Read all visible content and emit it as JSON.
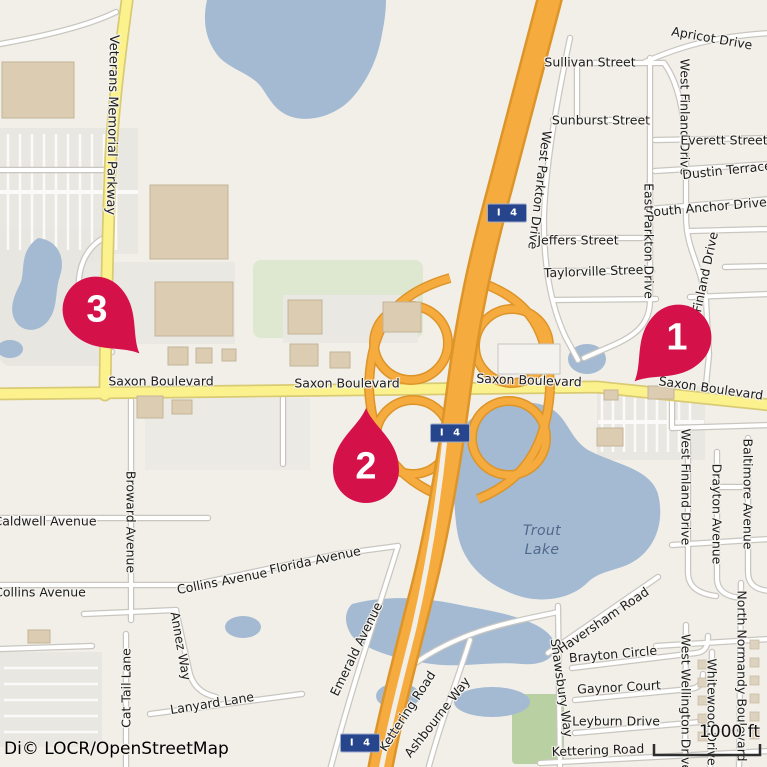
{
  "attribution": {
    "text": "Di© LOCR/OpenStreetMap"
  },
  "scale_bar": {
    "label": "1000 ft"
  },
  "shield_label": "I 4",
  "markers": [
    {
      "label": "1"
    },
    {
      "label": "2"
    },
    {
      "label": "3"
    }
  ],
  "water_label": {
    "line1": "Trout",
    "line2": "Lake"
  },
  "colors": {
    "marker": "#d5114a",
    "highway_fill": "#f5ab3e",
    "highway_casing": "#dd9428",
    "yellow_road_fill": "#fcf28d",
    "yellow_road_casing": "#d9cb74",
    "water": "#a3bad2",
    "shield": "#26458c",
    "land": "#f2efe9",
    "green": "#b9d0a2",
    "building": "#dbccb2"
  },
  "streets": [
    {
      "text": "Sullivan Street"
    },
    {
      "text": "Apricot Drive"
    },
    {
      "text": "Sunburst Street"
    },
    {
      "text": "West Finland Drive"
    },
    {
      "text": "Everett Street"
    },
    {
      "text": "Dustin Terrace"
    },
    {
      "text": "South Anchor Drive"
    },
    {
      "text": "Jeffers Street"
    },
    {
      "text": "Taylorville Street"
    },
    {
      "text": "West Parkton Drive"
    },
    {
      "text": "East Parkton Drive"
    },
    {
      "text": "Finland Drive"
    },
    {
      "text": "Saxon Boulevard"
    },
    {
      "text": "Saxon Boulevard"
    },
    {
      "text": "Saxon Boulevard"
    },
    {
      "text": "Saxon Boulevard"
    },
    {
      "text": "Veterans Memorial Parkway"
    },
    {
      "text": "Broward Avenue"
    },
    {
      "text": "Caldwell Avenue"
    },
    {
      "text": "Collins Avenue"
    },
    {
      "text": "Collins Avenue"
    },
    {
      "text": "Florida Avenue"
    },
    {
      "text": "Annez Way"
    },
    {
      "text": "Cat Tail Lane"
    },
    {
      "text": "Lanyard Lane"
    },
    {
      "text": "Emerald Avenue"
    },
    {
      "text": "Kettering Road"
    },
    {
      "text": "Ashbourne Way"
    },
    {
      "text": "Shawsbury Way"
    },
    {
      "text": "Haversham Road"
    },
    {
      "text": "Brayton Circle"
    },
    {
      "text": "Gaynor Court"
    },
    {
      "text": "Leyburn Drive"
    },
    {
      "text": "Kettering Road"
    },
    {
      "text": "North Normandy Boulevard"
    },
    {
      "text": "Whitewood Drive"
    },
    {
      "text": "West Wellington Drive"
    },
    {
      "text": "West Finland Drive"
    },
    {
      "text": "Drayton Avenue"
    },
    {
      "text": "Baltimore Avenue"
    }
  ]
}
